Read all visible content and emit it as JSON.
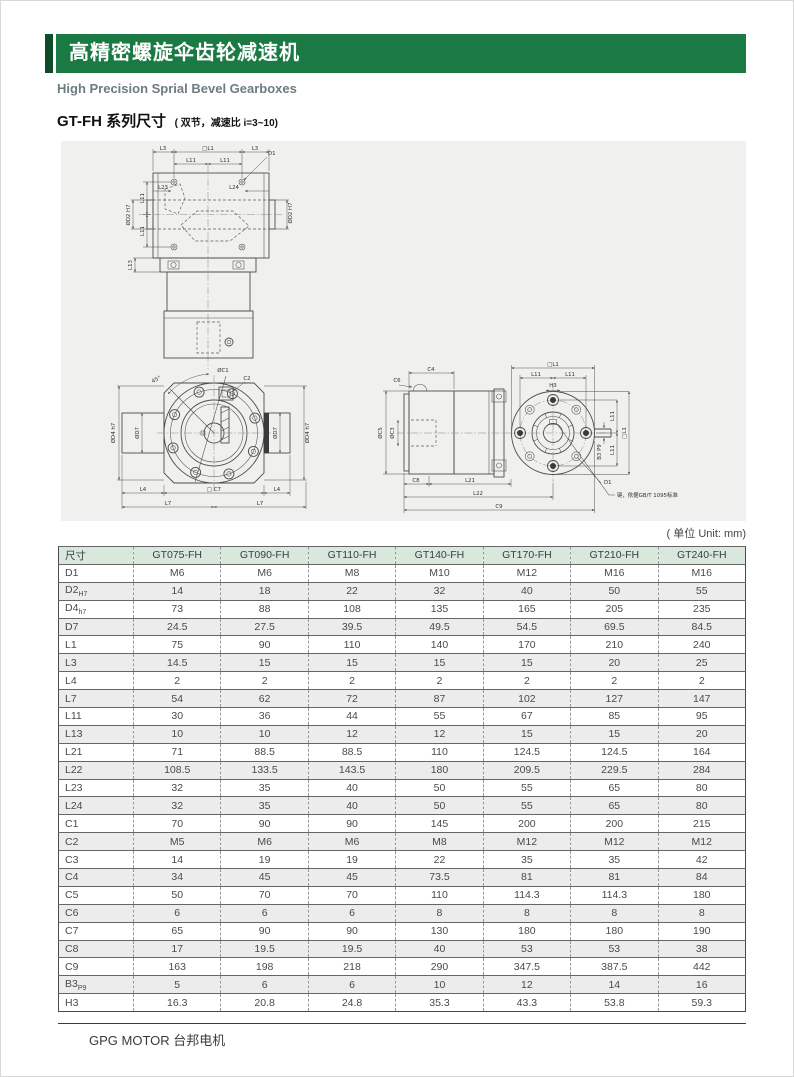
{
  "header": {
    "title_cn": "高精密螺旋伞齿轮减速机",
    "subtitle_en": "High Precision Sprial Bevel Gearboxes"
  },
  "section": {
    "title": "GT-FH 系列尺寸",
    "note": "( 双节，减速比 i=3~10)"
  },
  "unit_note": "( 单位 Unit: mm)",
  "footer": {
    "brand": "GPG MOTOR 台邦电机"
  },
  "colors": {
    "header_green": "#1b7a43",
    "accent_green": "#0c4c28",
    "subtitle_gray": "#6d7b82",
    "panel_bg": "#f0f0ee",
    "table_header_bg": "#d8e8dd",
    "row_alt_bg": "#ececec"
  },
  "drawings": {
    "top_view": {
      "l3_left": "L3",
      "l1_square": "□L1",
      "l3_right": "L3",
      "d1": "D1",
      "l11_top_left": "L11",
      "l11_top_right": "L11",
      "l23": "L23",
      "l24": "L24",
      "d2_right": "ØD2 H7",
      "l11_left_upper": "L11",
      "l11_left_lower": "L11",
      "d2_left": "ØD2 H7",
      "l13": "L13"
    },
    "front_view": {
      "angle": "45°",
      "c1": "ØC1",
      "c2": "C2",
      "d4_left": "ØD4 h7",
      "d7_left": "ØD7",
      "d7_right": "ØD7",
      "d4_right": "ØD4 h7",
      "l4_left": "L4",
      "c7_square": "□ C7",
      "l4_right": "L4",
      "l7_left": "L7",
      "l7_right": "L7"
    },
    "side_view": {
      "c4": "C4",
      "c6": "C6",
      "l1_square_top": "□L1",
      "l11_top_left": "L11",
      "l11_top_right": "L11",
      "h3": "H3",
      "c5": "ØC5",
      "c3": "ØC3",
      "l11_right_upper": "L11",
      "l11_right_lower": "L11",
      "l1_square_right": "□L1",
      "b3": "B3 P9",
      "c8": "C8",
      "l21": "L21",
      "l22": "L22",
      "c9": "C9",
      "d1": "D1",
      "key_note": "键，依据GB/T 1095标准"
    }
  },
  "table": {
    "columns": [
      "尺寸",
      "GT075-FH",
      "GT090-FH",
      "GT110-FH",
      "GT140-FH",
      "GT170-FH",
      "GT210-FH",
      "GT240-FH"
    ],
    "rows": [
      {
        "dim": "D1",
        "sub": "",
        "values": [
          "M6",
          "M6",
          "M8",
          "M10",
          "M12",
          "M16",
          "M16"
        ]
      },
      {
        "dim": "D2",
        "sub": "H7",
        "values": [
          "14",
          "18",
          "22",
          "32",
          "40",
          "50",
          "55"
        ]
      },
      {
        "dim": "D4",
        "sub": "h7",
        "values": [
          "73",
          "88",
          "108",
          "135",
          "165",
          "205",
          "235"
        ]
      },
      {
        "dim": "D7",
        "sub": "",
        "values": [
          "24.5",
          "27.5",
          "39.5",
          "49.5",
          "54.5",
          "69.5",
          "84.5"
        ]
      },
      {
        "dim": "L1",
        "sub": "",
        "values": [
          "75",
          "90",
          "110",
          "140",
          "170",
          "210",
          "240"
        ]
      },
      {
        "dim": "L3",
        "sub": "",
        "values": [
          "14.5",
          "15",
          "15",
          "15",
          "15",
          "20",
          "25"
        ]
      },
      {
        "dim": "L4",
        "sub": "",
        "values": [
          "2",
          "2",
          "2",
          "2",
          "2",
          "2",
          "2"
        ]
      },
      {
        "dim": "L7",
        "sub": "",
        "values": [
          "54",
          "62",
          "72",
          "87",
          "102",
          "127",
          "147"
        ]
      },
      {
        "dim": "L11",
        "sub": "",
        "values": [
          "30",
          "36",
          "44",
          "55",
          "67",
          "85",
          "95"
        ]
      },
      {
        "dim": "L13",
        "sub": "",
        "values": [
          "10",
          "10",
          "12",
          "12",
          "15",
          "15",
          "20"
        ]
      },
      {
        "dim": "L21",
        "sub": "",
        "values": [
          "71",
          "88.5",
          "88.5",
          "110",
          "124.5",
          "124.5",
          "164"
        ]
      },
      {
        "dim": "L22",
        "sub": "",
        "values": [
          "108.5",
          "133.5",
          "143.5",
          "180",
          "209.5",
          "229.5",
          "284"
        ]
      },
      {
        "dim": "L23",
        "sub": "",
        "values": [
          "32",
          "35",
          "40",
          "50",
          "55",
          "65",
          "80"
        ]
      },
      {
        "dim": "L24",
        "sub": "",
        "values": [
          "32",
          "35",
          "40",
          "50",
          "55",
          "65",
          "80"
        ]
      },
      {
        "dim": "C1",
        "sub": "",
        "values": [
          "70",
          "90",
          "90",
          "145",
          "200",
          "200",
          "215"
        ]
      },
      {
        "dim": "C2",
        "sub": "",
        "values": [
          "M5",
          "M6",
          "M6",
          "M8",
          "M12",
          "M12",
          "M12"
        ]
      },
      {
        "dim": "C3",
        "sub": "",
        "values": [
          "14",
          "19",
          "19",
          "22",
          "35",
          "35",
          "42"
        ]
      },
      {
        "dim": "C4",
        "sub": "",
        "values": [
          "34",
          "45",
          "45",
          "73.5",
          "81",
          "81",
          "84"
        ]
      },
      {
        "dim": "C5",
        "sub": "",
        "values": [
          "50",
          "70",
          "70",
          "110",
          "114.3",
          "114.3",
          "180"
        ]
      },
      {
        "dim": "C6",
        "sub": "",
        "values": [
          "6",
          "6",
          "6",
          "8",
          "8",
          "8",
          "8"
        ]
      },
      {
        "dim": "C7",
        "sub": "",
        "values": [
          "65",
          "90",
          "90",
          "130",
          "180",
          "180",
          "190"
        ]
      },
      {
        "dim": "C8",
        "sub": "",
        "values": [
          "17",
          "19.5",
          "19.5",
          "40",
          "53",
          "53",
          "38"
        ]
      },
      {
        "dim": "C9",
        "sub": "",
        "values": [
          "163",
          "198",
          "218",
          "290",
          "347.5",
          "387.5",
          "442"
        ]
      },
      {
        "dim": "B3",
        "sub": "P9",
        "values": [
          "5",
          "6",
          "6",
          "10",
          "12",
          "14",
          "16"
        ]
      },
      {
        "dim": "H3",
        "sub": "",
        "values": [
          "16.3",
          "20.8",
          "24.8",
          "35.3",
          "43.3",
          "53.8",
          "59.3"
        ]
      }
    ]
  }
}
